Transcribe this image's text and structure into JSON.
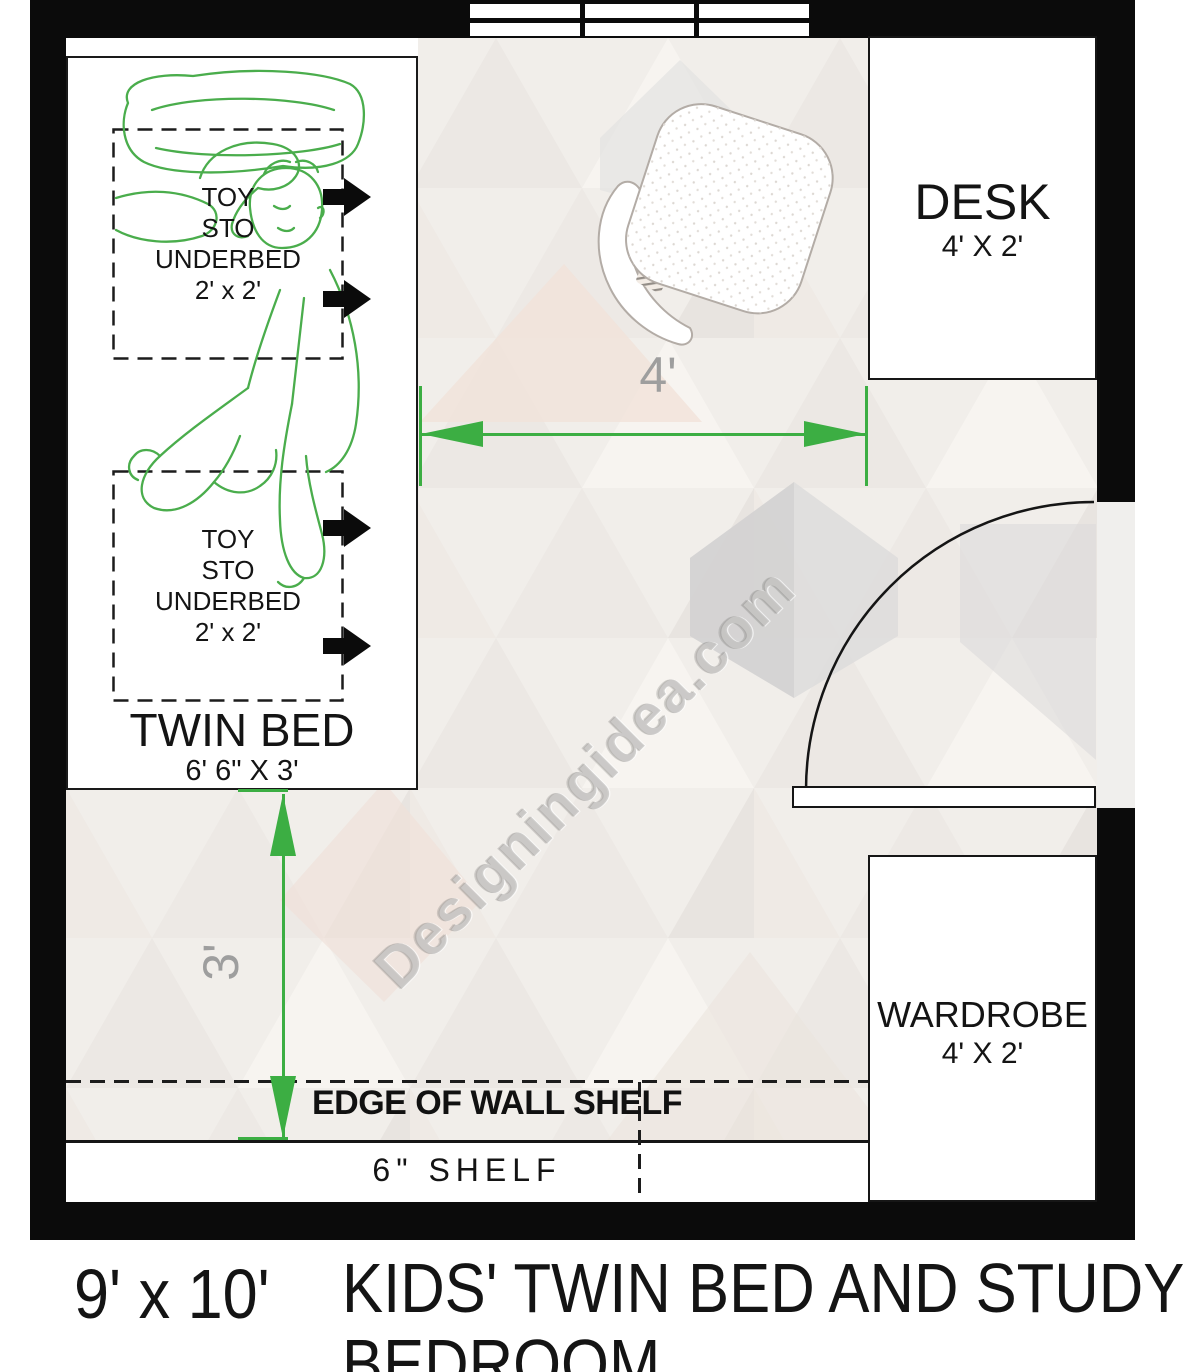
{
  "caption": {
    "room_size": "9' x 10'",
    "title_line1": "KIDS' TWIN BED AND STUDY",
    "title_line2": "BEDROOM"
  },
  "watermark": {
    "text": "Designingidea.com"
  },
  "furniture": {
    "bed": {
      "label": "TWIN BED",
      "size": "6' 6\" X 3'"
    },
    "desk": {
      "label": "DESK",
      "size": "4' X 2'"
    },
    "wardrobe": {
      "label": "WARDROBE",
      "size": "4' X 2'"
    },
    "toy_storage": {
      "lines": [
        "TOY",
        "STO",
        "UNDERBED",
        "2' x 2'"
      ]
    }
  },
  "shelf": {
    "edge_label": "EDGE OF WALL SHELF",
    "label": "6\" SHELF"
  },
  "dimensions": {
    "bed_to_desk": "4'",
    "bed_to_shelf": "3'"
  },
  "colors": {
    "dimension_green": "#3cae43",
    "figure_green": "#4aad4c",
    "wall_black": "#0b0b0b",
    "dim_text_gray": "#9e9e9e",
    "watermark_gray": "#9e9b98"
  }
}
